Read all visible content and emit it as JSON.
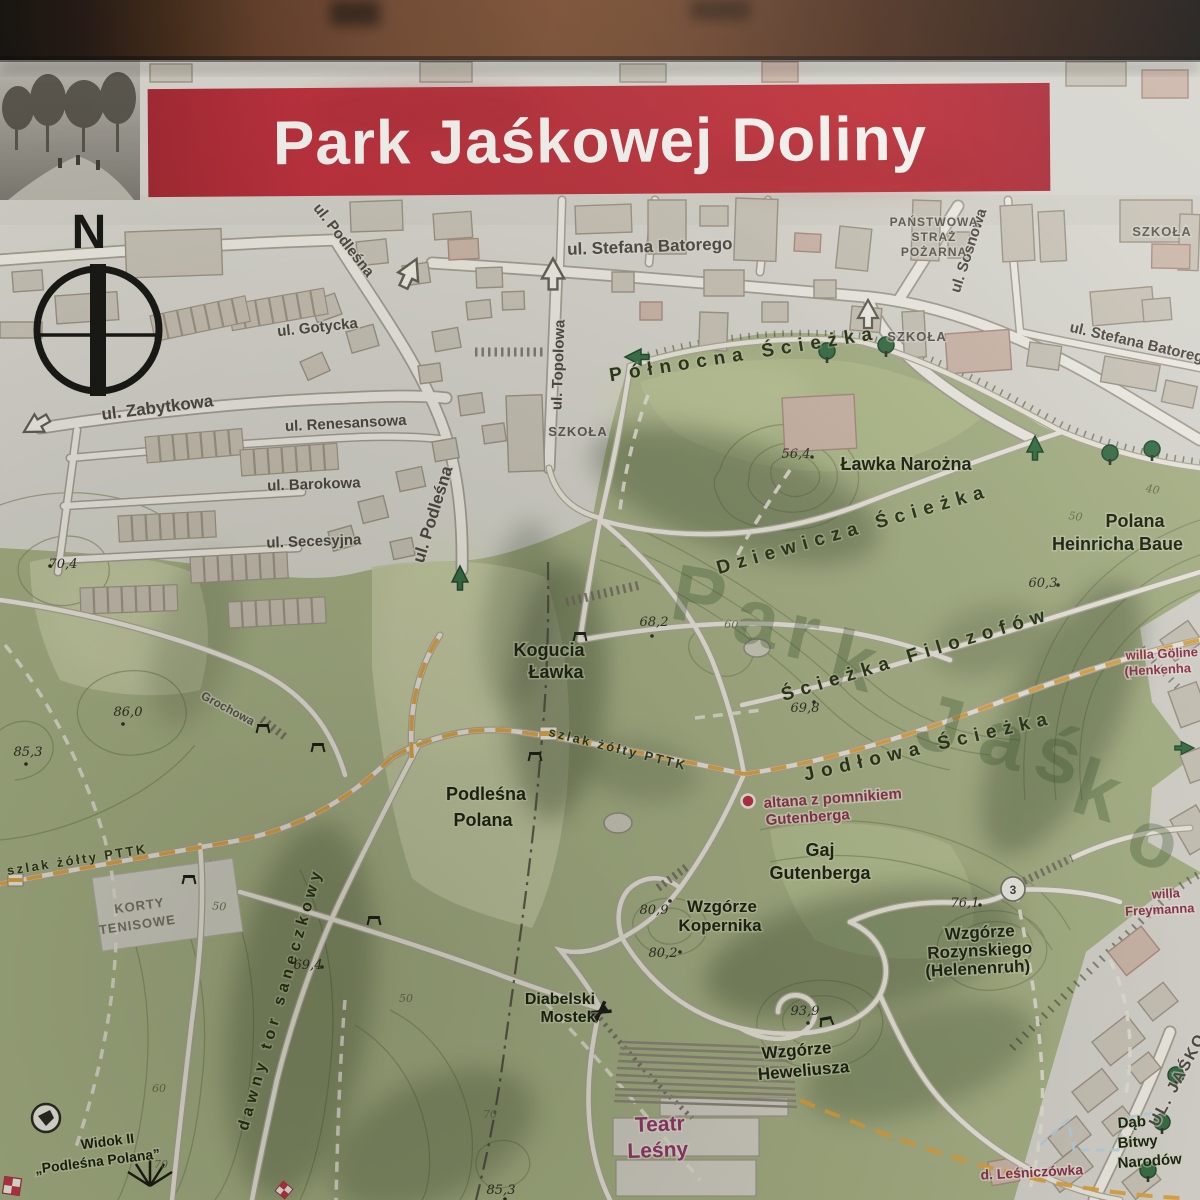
{
  "board": {
    "title": "Park Jaśkowej Doliny"
  },
  "compass": {
    "north": "N"
  },
  "streets": {
    "podlesna_nw": "ul. Podleśna",
    "batorego": "ul. Stefana Batorego",
    "topolowa": "ul. Topolowa",
    "sosnowa": "ul. Sosnowa",
    "batorego_e": "ul. Stefana Batorego",
    "gotycka": "ul. Gotycka",
    "zabytkowa": "ul. Zabytkowa",
    "renesansowa": "ul. Renesansowa",
    "barokowa": "ul. Barokowa",
    "secesyjna": "ul. Secesyjna",
    "podlesna_mid": "ul. Podleśna",
    "grochowa": "Grochowa",
    "jaskowa": "UL. JAŚKO"
  },
  "buildings": {
    "fire1": "PAŃSTWOWA",
    "fire2": "STRAŻ",
    "fire3": "POŻARNA",
    "school_ne": "SZKOŁA",
    "school_mid": "SZKOŁA",
    "school_w": "SZKOŁA",
    "tennis1": "KORTY",
    "tennis2": "TENISOWE"
  },
  "paths": {
    "polnocna": "Północna Ścieżka",
    "dziewicza": "Dziewicza Ścieżka",
    "filozofow": "Ścieżka Filozofów",
    "jodlowa": "Jodłowa Ścieżka",
    "szlak_center": "szlak żółty PTTK",
    "szlak_west": "szlak żółty PTTK",
    "saneczkowy": "dawny tor saneczkowy"
  },
  "places": {
    "lawka_narozna": "Ławka Narożna",
    "polana_h1": "Polana",
    "polana_h2": "Heinricha Baue",
    "kogucia1": "Kogucia",
    "kogucia2": "Ławka",
    "podlesna_polana1": "Podleśna",
    "podlesna_polana2": "Polana",
    "gaj1": "Gaj",
    "gaj2": "Gutenberga",
    "kopernika1": "Wzgórze",
    "kopernika2": "Kopernika",
    "rozynskiego1": "Wzgórze",
    "rozynskiego2": "Rozynskiego",
    "rozynskiego3": "(Helenenruh)",
    "heweliusza1": "Wzgórze",
    "heweliusza2": "Heweliusza",
    "diabelski1": "Diabelski",
    "diabelski2": "Mostek",
    "dab1": "Dąb",
    "dab2": "Bitwy",
    "dab3": "Narodów",
    "widok1": "Widok II",
    "widok2": "„Podleśna Polana”"
  },
  "attractions": {
    "altana1": "altana z pomnikiem",
    "altana2": "Gutenberga",
    "teatr1": "Teatr",
    "teatr2": "Leśny",
    "willa_g1": "willa Göline",
    "willa_g2": "(Henkenha",
    "willa_f1": "willa",
    "willa_f2": "Freymanna",
    "lesniczowka": "d. Leśniczówka"
  },
  "heights": {
    "h704": "70,4",
    "h860": "86,0",
    "h853w": "85,3",
    "h564": "56,4",
    "h603": "60,3",
    "h682": "68,2",
    "h698": "69,8",
    "h809": "80,9",
    "h802": "80,2",
    "h761": "76,1",
    "h939": "93,9",
    "h694": "69,4",
    "h853s": "85,3"
  },
  "contours": {
    "c40": "40",
    "c50a": "50",
    "c50b": "50",
    "c50c": "50",
    "c60a": "60",
    "c60b": "60",
    "c70a": "70",
    "c70b": "70"
  },
  "markers": {
    "route3": "3"
  },
  "watermark": {
    "w1": "P",
    "w2": "a",
    "w3": "r",
    "w4": "k",
    "w5": "J",
    "w6": "a",
    "w7": "ś",
    "w8": "k",
    "w9": "o"
  },
  "colors": {
    "banner_red": "#bd2433",
    "park_green": "#a7b285",
    "trail_yellow": "#dfa23a",
    "label_magenta": "#963063"
  }
}
